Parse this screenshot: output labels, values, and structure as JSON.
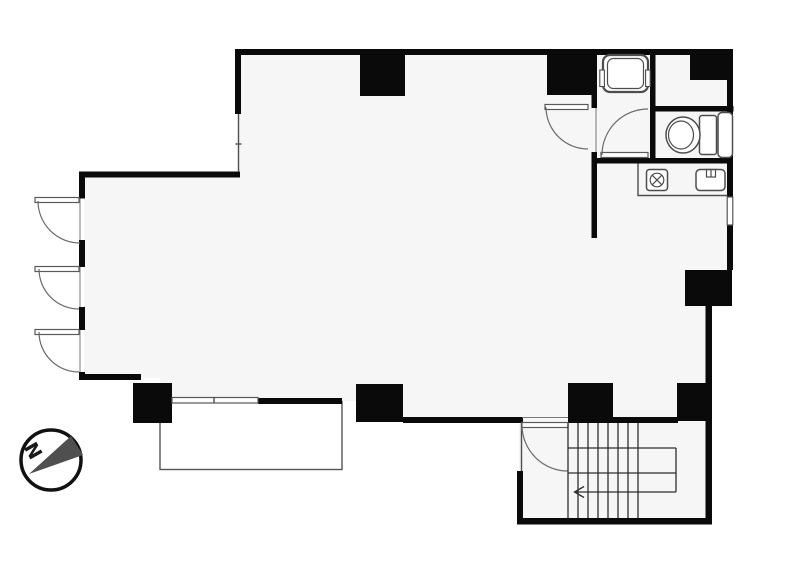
{
  "compass": {
    "label": "N"
  },
  "colors": {
    "wall": "#0a0a0a",
    "fixture_line": "#4d4d4d",
    "floor": "#f6f6f6",
    "background": "#ffffff",
    "needle": "#4f4f4f"
  },
  "staircase": {
    "tread_count": 8,
    "direction_arrow": "left"
  }
}
